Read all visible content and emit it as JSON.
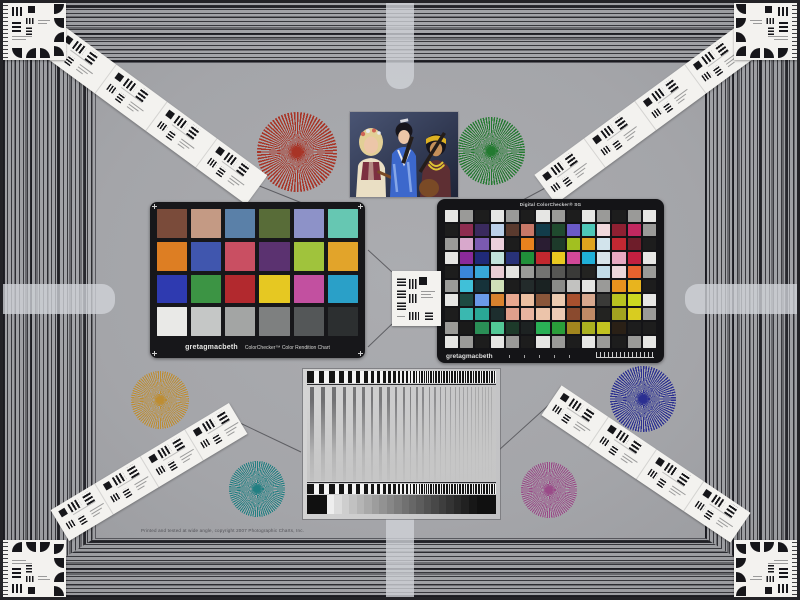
{
  "scene": {
    "description": "Camera color and resolution test chart scene",
    "background_color": "#a6a7ab",
    "frame_color": "#232327",
    "border_line_color": "#1e1e24",
    "edge_marker_color": "#d1d4d9"
  },
  "colorchecker_classic": {
    "brand": "gretagmacbeth",
    "title": "ColorChecker™ Color Rendition Chart",
    "rows": [
      [
        "#7a4b3a",
        "#c49a84",
        "#5a80a8",
        "#586c38",
        "#8d92c8",
        "#66c7b2"
      ],
      [
        "#dd7e23",
        "#4056ae",
        "#c94f62",
        "#5b3270",
        "#a0c33c",
        "#e2a42a"
      ],
      [
        "#2e3ab0",
        "#3c9444",
        "#b2292e",
        "#e6c822",
        "#c250a0",
        "#2aa0c8"
      ],
      [
        "#e9e9e7",
        "#c5c7c6",
        "#a3a5a4",
        "#7e8080",
        "#545758",
        "#2c2f30"
      ]
    ]
  },
  "colorchecker_sg": {
    "title": "Digital ColorChecker® SG",
    "brand": "gretagmacbeth",
    "rows": [
      [
        "#e6e6e4",
        "#9a9a98",
        "#1d1d1d",
        "#e6e6e4",
        "#9a9a98",
        "#1d1d1d",
        "#e6e6e4",
        "#9a9a98",
        "#1d1d1d",
        "#e6e6e4",
        "#9a9a98",
        "#1d1d1d",
        "#9a9a98",
        "#e6e6e4"
      ],
      [
        "#1d1d1d",
        "#8e2c50",
        "#3a2a5e",
        "#bcd0e8",
        "#5a3a2e",
        "#c87868",
        "#123c4a",
        "#1f4a2e",
        "#6a5ac8",
        "#4ec8b8",
        "#f0d8dc",
        "#8e2032",
        "#c22860",
        "#9a9a98"
      ],
      [
        "#9a9a98",
        "#d8a8cc",
        "#7a5ab0",
        "#ecd0dc",
        "#1d1d1d",
        "#e8821e",
        "#2a1d32",
        "#1d3a2a",
        "#a2c020",
        "#e0a41e",
        "#d2e4ec",
        "#c22832",
        "#6e1d2a",
        "#1d1d1d"
      ],
      [
        "#e6e6e4",
        "#8a2a9a",
        "#202a78",
        "#c2e2dc",
        "#283278",
        "#20903a",
        "#c2282e",
        "#e8c820",
        "#d24898",
        "#20b0d8",
        "#d8e4ea",
        "#e8a8c2",
        "#c22040",
        "#e6e6e4"
      ],
      [
        "#1d1d1d",
        "#3a86d8",
        "#38a8d8",
        "#e8ccd4",
        "#e2e2e0",
        "#9a9a98",
        "#737371",
        "#565654",
        "#3a3a38",
        "#232321",
        "#c2dce8",
        "#ecd6da",
        "#e8622e",
        "#9a9a98"
      ],
      [
        "#9a9a98",
        "#40c0d8",
        "#16323a",
        "#d0e0b8",
        "#1d1d1d",
        "#232b2b",
        "#1a2222",
        "#8a8a88",
        "#c2c2c0",
        "#e4e4e2",
        "#9a9a98",
        "#e8921e",
        "#e8b41e",
        "#1d1d1d"
      ],
      [
        "#e6e6e4",
        "#1d4a42",
        "#6a9ae8",
        "#d8822e",
        "#e8a890",
        "#ecc0a2",
        "#8a563a",
        "#eccab0",
        "#a8502e",
        "#d8a88e",
        "#3a3a38",
        "#b8c220",
        "#ccd820",
        "#e6e6e4"
      ],
      [
        "#1d1d1d",
        "#3ab8b0",
        "#2aa896",
        "#1d2e2e",
        "#e0a08c",
        "#e8b4a0",
        "#ecc4aa",
        "#eccab4",
        "#8a4a2e",
        "#c08a66",
        "#232321",
        "#a2a220",
        "#d8cc20",
        "#9a9a98"
      ],
      [
        "#9a9a98",
        "#1a1a1a",
        "#2a8e56",
        "#52c896",
        "#1d3a2a",
        "#1d2222",
        "#2ab056",
        "#2a9e3a",
        "#a2861e",
        "#aab020",
        "#c2c220",
        "#2a2016",
        "#1d1d1d",
        "#1d1d1d"
      ],
      [
        "#e6e6e4",
        "#9a9a98",
        "#1d1d1d",
        "#e6e6e4",
        "#9a9a98",
        "#1d1d1d",
        "#e6e6e4",
        "#9a9a98",
        "#1d1d1d",
        "#e6e6e4",
        "#9a9a98",
        "#1d1d1d",
        "#9a9a98",
        "#e6e6e4"
      ]
    ]
  },
  "starbursts": [
    {
      "name": "red",
      "color": "#a83426",
      "cx": 297,
      "cy": 152,
      "r": 40
    },
    {
      "name": "green",
      "color": "#237a30",
      "cx": 491,
      "cy": 151,
      "r": 34
    },
    {
      "name": "ochre",
      "color": "#bd8d33",
      "cx": 160,
      "cy": 400,
      "r": 29
    },
    {
      "name": "blue",
      "color": "#2b2f91",
      "cx": 643,
      "cy": 399,
      "r": 33
    },
    {
      "name": "teal",
      "color": "#217f82",
      "cx": 257,
      "cy": 489,
      "r": 28
    },
    {
      "name": "magenta",
      "color": "#9a4a88",
      "cx": 549,
      "cy": 490,
      "r": 28
    }
  ],
  "photo": {
    "subject": "Portrait of three costumed musicians with instruments",
    "colors": {
      "bg_light": "#4a5574",
      "bg_dark": "#1e2438",
      "skin_light": "#ecc6a8",
      "skin_tan": "#c5905a",
      "hair_blonde": "#e2cf96",
      "hair_dark": "#17151c",
      "flower_red": "#cf6456",
      "dress_cream": "#eadfc4",
      "bodice_red": "#7c3040",
      "kimono_blue": "#3c68cc",
      "kimono_stripe": "#85a6e8",
      "headband_yellow": "#ddb122",
      "necklace_yellow": "#dfc233",
      "robe_dark": "#5e2f33",
      "instrument_brown": "#7a4a26",
      "instrument_dark": "#241d1a"
    }
  },
  "targets": {
    "card": "#f3f2ef",
    "ink": "#16161a",
    "text": "#9a9a9a"
  },
  "sweep_chart": {
    "tick_dark": "#141414",
    "tick_light": "#f4f4f4",
    "line_color": "#2a2a2e",
    "step_light": "#eeeeee",
    "step_dark": "#171717",
    "end_square": "#101010"
  },
  "fine_print": "Printed and tested at wide angle, copyright 2007 Photographic Charts, Inc."
}
